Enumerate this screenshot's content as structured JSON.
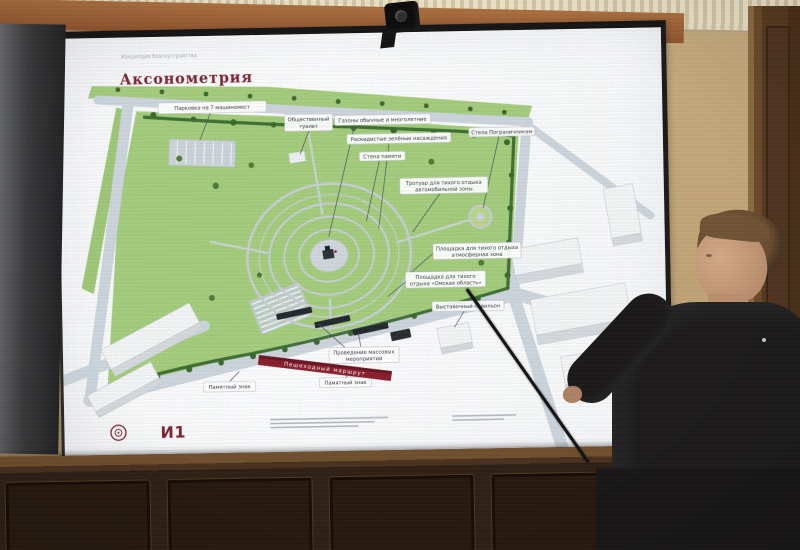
{
  "slide": {
    "eyebrow": "Концепция благоустройства",
    "title": "Аксонометрия",
    "accent_color": "#7e2433",
    "map_labels": [
      {
        "text": "Парковка на 7 машиномест"
      },
      {
        "line1": "Общественный",
        "line2": "туалет"
      },
      {
        "text": "Газоны обычные и многолетние"
      },
      {
        "text": "Раскидистые зелёные насаждения"
      },
      {
        "text": "Стена памяти"
      },
      {
        "text": "Стела Пограничникам"
      },
      {
        "line1": "Тротуар для тихого отдыха",
        "line2": "автомобильной зоны"
      },
      {
        "line1": "Площадка для тихого отдыха",
        "line2": "атмосферная зона"
      },
      {
        "line1": "Площадка для тихого",
        "line2": "отдыха «Омская область»"
      },
      {
        "text": "Выставочный павильон"
      },
      {
        "line1": "Проведение массовых",
        "line2": "мероприятий"
      },
      {
        "text": "Памятный знак"
      },
      {
        "text": "Памятный знак"
      }
    ],
    "route_ribbon": "Пешеходный маршрут",
    "footer": {
      "logo_text": "И1"
    }
  },
  "colors": {
    "park_green": "#a5cd7d",
    "tree_green": "#3a6b2e",
    "road_gray": "#cdd5dd",
    "accent_red": "#8b1f2e",
    "wall_tan": "#bfa376",
    "wood_brown": "#2d1f14"
  }
}
